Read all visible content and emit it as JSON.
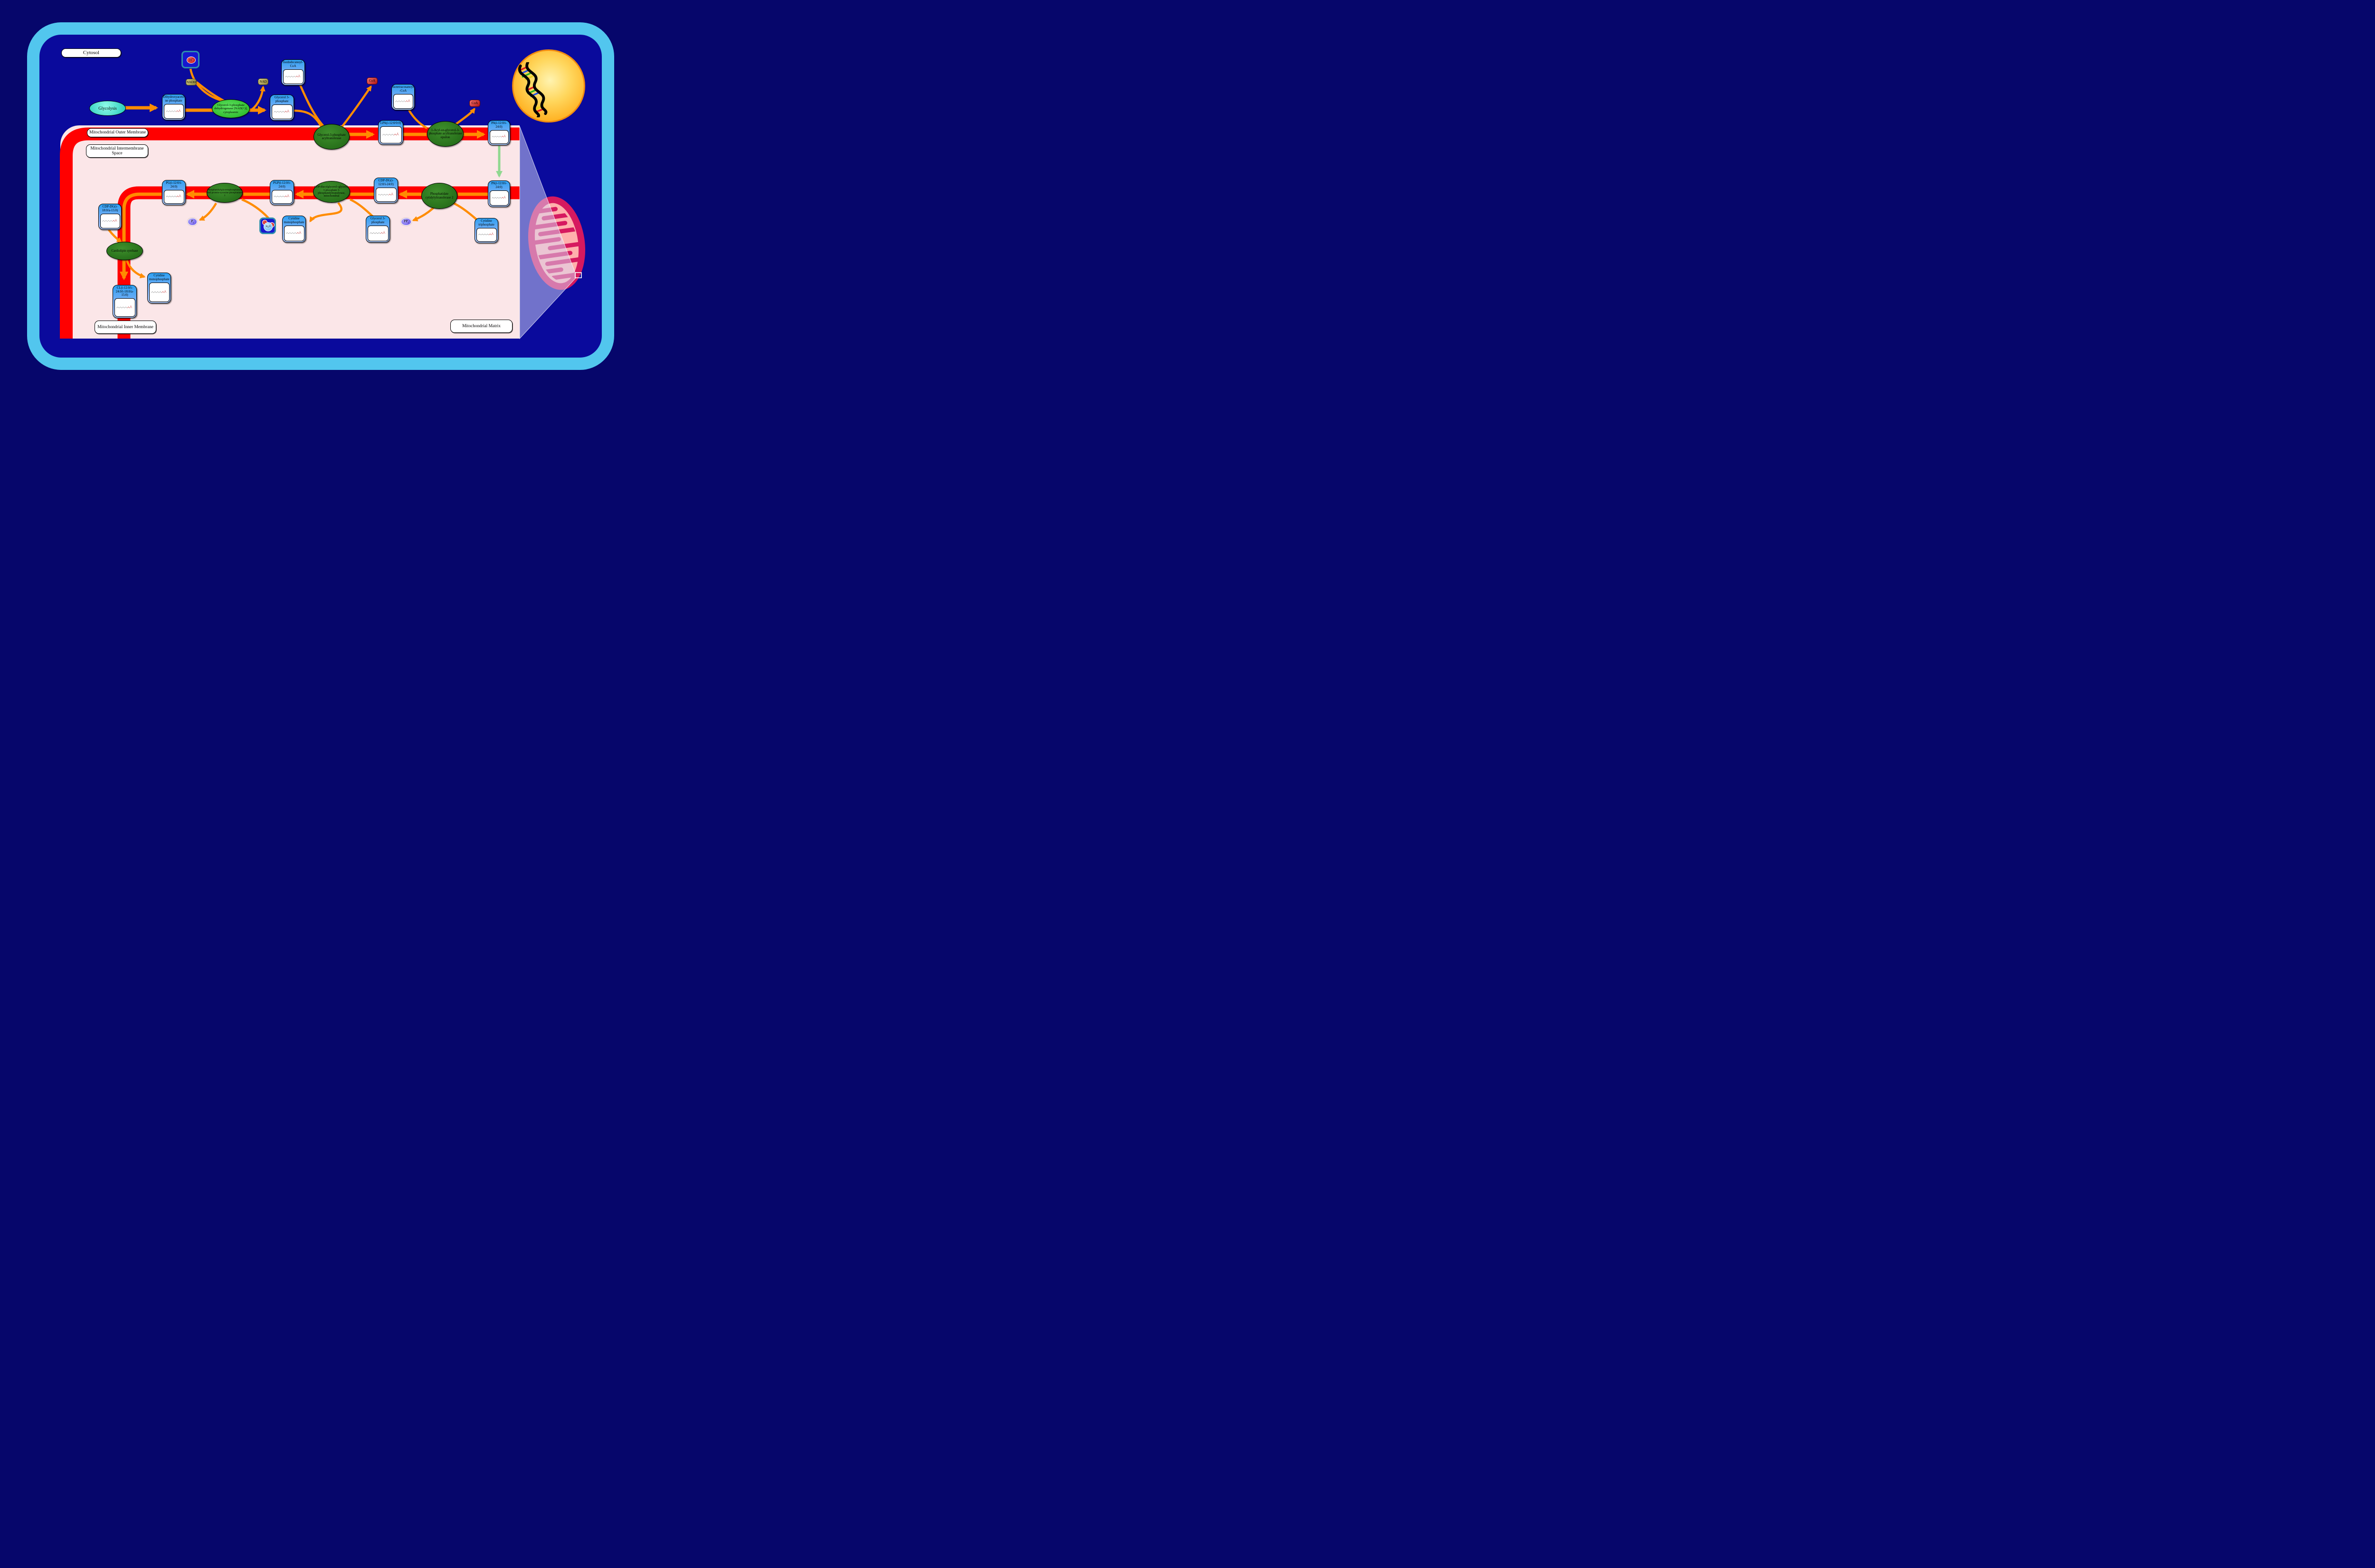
{
  "regions": {
    "cytosol": "Cytosol",
    "outer_membrane": "Mitochondrial Outer Membrane",
    "intermembrane_space": "Mitochondrial Intermembrane Space",
    "inner_membrane": "Mitochondrial Inner Membrane",
    "matrix": "Mitochondrial Matrix"
  },
  "process": {
    "glycolysis": "Glycolysis"
  },
  "enzymes": {
    "gpd1": "Glycerol-3-phosphate dehydrogenase [NAD(+)], cytoplasmic",
    "gpat": "Glycerol-3-phosphate acyltransferase",
    "agpat_epsilon": "1-Acyl-sn-glycerol-3-phosphate acyltransferase epsilon",
    "pcyt2": "Phosphatidate cytidylyltransferase 2",
    "pgs1": "CDP-diacylglycerol--glycerol-3-phosphate 3-phosphatidyltransferase, mitochondrial",
    "ptpmt1": "Phosphatidylglycerophosphatase and protein-tyrosine phosphatase 1",
    "cardiolipin_synthase": "Cardiolipin synthase"
  },
  "metabolites": {
    "dhap": "Dihydroxyacetone phosphate",
    "g3p_cytosol": "Glycerol 3-phosphate",
    "isododecanoyl_coa": "Isododecanoyl-CoA",
    "lpa": "LPA(i-12:0/0:0)",
    "isotetracosanoyl_coa": "Isotetracosanoyl-CoA",
    "pa_outer": "PA(i-12:0/i-24:0)",
    "pa_inner": "PA(i-12:0/i-24:0)",
    "ctp": "Cytidine triphosphate",
    "cdp_dg": "CDP-DG(i-12:0/i-24:0)",
    "g3p_matrix": "Glycerol 3-phosphate",
    "cmp_pgs": "Cytidine monophosphate",
    "pgp": "PGP(i-12:0/i-24:0)",
    "pg": "PG(i-12:0/i-24:0)",
    "cdp_dg_2": "CDP-DG(i-18:0/a-15:0)",
    "cl": "CL(i-12:0/i-24:0/i-18:0/a-15:0)",
    "cmp_cls": "Cytidine monophosphate"
  },
  "cofactors": {
    "nadh": "NADH",
    "nad": "NAD",
    "coa_gpat": "CoA",
    "coa_agpat": "CoA",
    "proton": {
      "base": "H",
      "sup": "+"
    },
    "water": {
      "h": "H",
      "sub": "2",
      "o": "O"
    },
    "ppi": {
      "base": "PP",
      "sub": "i"
    },
    "pi": {
      "base": "P",
      "sub": "i"
    }
  },
  "colors": {
    "cell_membrane": "#52C6EE",
    "cytosol_fill": "#0A0A9C",
    "page_bg": "#06066B",
    "mito_membrane_red": "#FF0000",
    "matrix_pink": "#FBE6E8",
    "arrow_orange": "#FF8C00",
    "transport_arrow_green": "#90D890",
    "metabolite_blue": "#2D9FF2",
    "enzyme_green_dark": "#2F7D22",
    "enzyme_green_bright": "#2FCB2F",
    "nucleus_yellow": "#FFC125",
    "mitochondrion_crimson": "#D6195F"
  }
}
